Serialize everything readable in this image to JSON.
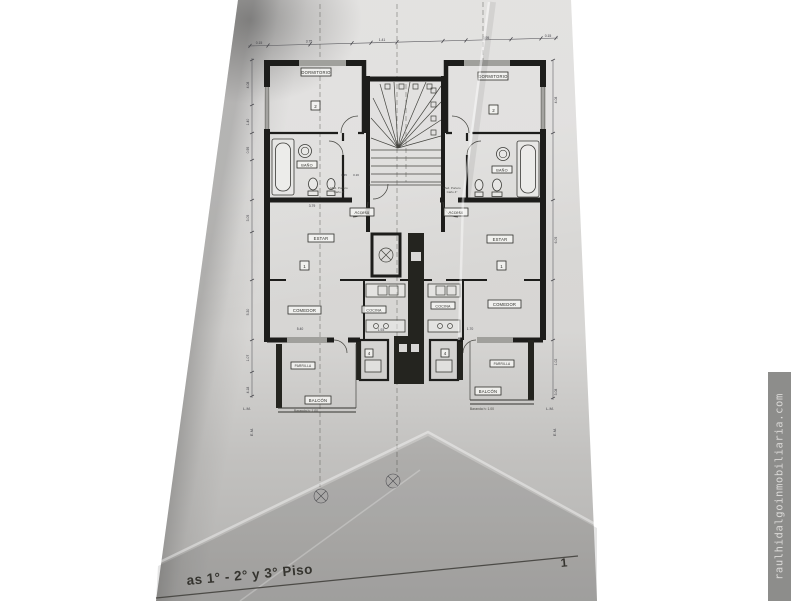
{
  "watermark": {
    "text": "raulhidalgoinmobiliaria.com"
  },
  "caption": {
    "text": "as 1° - 2° y 3° Piso",
    "page_number": "1"
  },
  "plan": {
    "labels": {
      "bedroom": "DORMITORIO",
      "bath": "BAÑO",
      "living": "ESTAR",
      "dining": "COMEDOR",
      "kitchen": "COCINA",
      "grill": "PARRILLA",
      "balcony": "BALCÓN",
      "balcony_note": "Baranda h: 1.00",
      "entry": "Acceso",
      "no1": "1",
      "no2": "2",
      "no4": "4"
    },
    "notes": {
      "med_portero": "Med. Portero",
      "cano": "Caño 4\""
    },
    "edge": {
      "lm": "L.M.",
      "em": "E.M."
    },
    "dims_top": [
      "0.15",
      "3.75",
      "1.41",
      "3.95",
      "0.15"
    ],
    "dims_left": [
      "4.08",
      "1.40",
      "0.95",
      "3.05",
      "5.30",
      "1.07",
      "4.18"
    ],
    "dims_right": [
      "4.08",
      "6.05",
      "1.02",
      "3.08"
    ],
    "dims_inner": [
      "3.79",
      "1.45",
      "0.16",
      "5.40",
      "1.93",
      "1.70"
    ]
  }
}
